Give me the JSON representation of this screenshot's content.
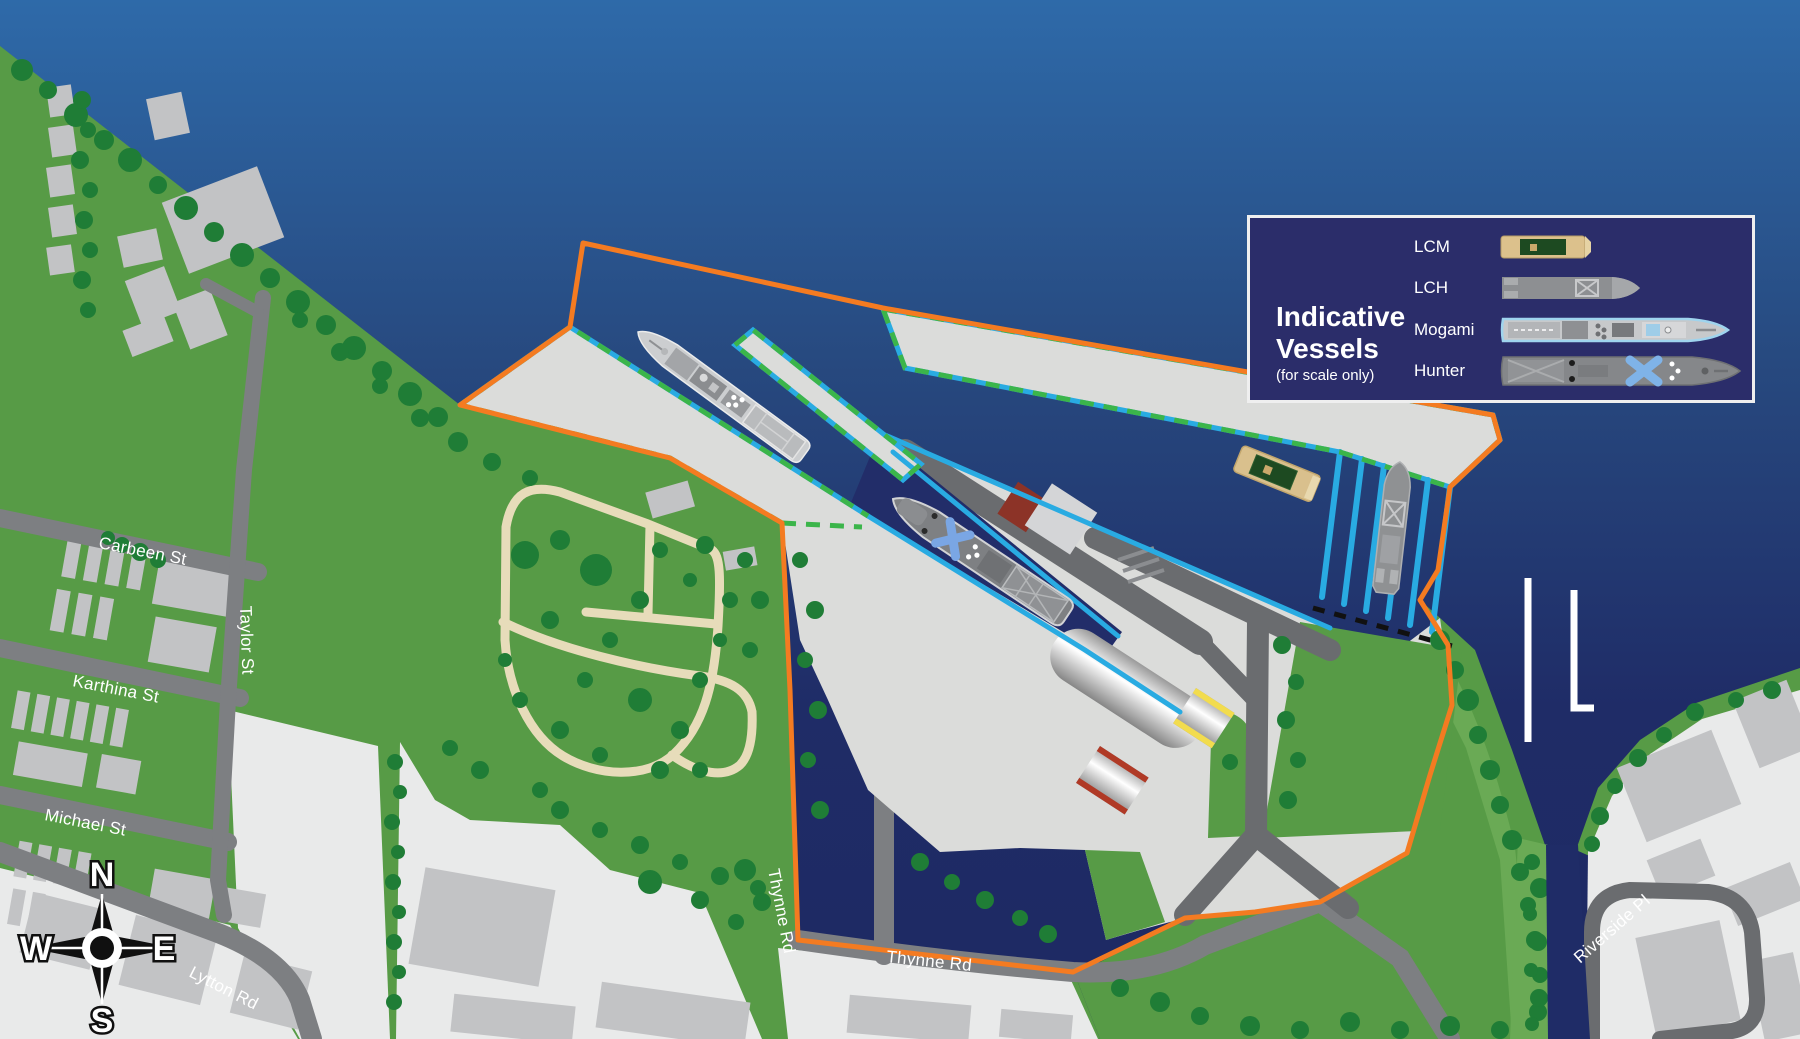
{
  "title": "Port precinct map",
  "streets": {
    "carbeen": "Carbeen St",
    "taylor": "Taylor St",
    "karthina": "Karthina St",
    "michael": "Michael St",
    "lytton": "Lytton Rd",
    "thynne_v": "Thynne Rd",
    "thynne_h": "Thynne Rd",
    "riverside": "Riverside Pl"
  },
  "compass": {
    "north": "N",
    "south": "S",
    "east": "E",
    "west": "W"
  },
  "legend": {
    "title_line1": "Indicative",
    "title_line2": "Vessels",
    "subtitle": "(for scale only)",
    "vessels": [
      {
        "label": "LCM"
      },
      {
        "label": "LCH"
      },
      {
        "label": "Mogami"
      },
      {
        "label": "Hunter"
      }
    ]
  },
  "colors": {
    "water-top": "#2e6aa9",
    "water-mid": "#27497f",
    "water-deep": "#1f2c67",
    "channel-navy": "#222d69",
    "land": "#579b46",
    "land-light": "#6aaa55",
    "tree": "#1f7d36",
    "road": "#7d7f82",
    "road-dark": "#6a6c6f",
    "paved": "#e9eaea",
    "building": "#c2c3c5",
    "concrete": "#dbdcda",
    "boundary-orange": "#f47b21",
    "dash-green": "#3bb54a",
    "edge-cyan": "#29abe2",
    "legend-bg": "#2b2d6a",
    "path-beige": "#e7dcba",
    "maroon": "#8c3327",
    "gate-yellow": "#f2dc4e",
    "gate-red": "#b03a26",
    "jetty-white": "#ffffff"
  }
}
